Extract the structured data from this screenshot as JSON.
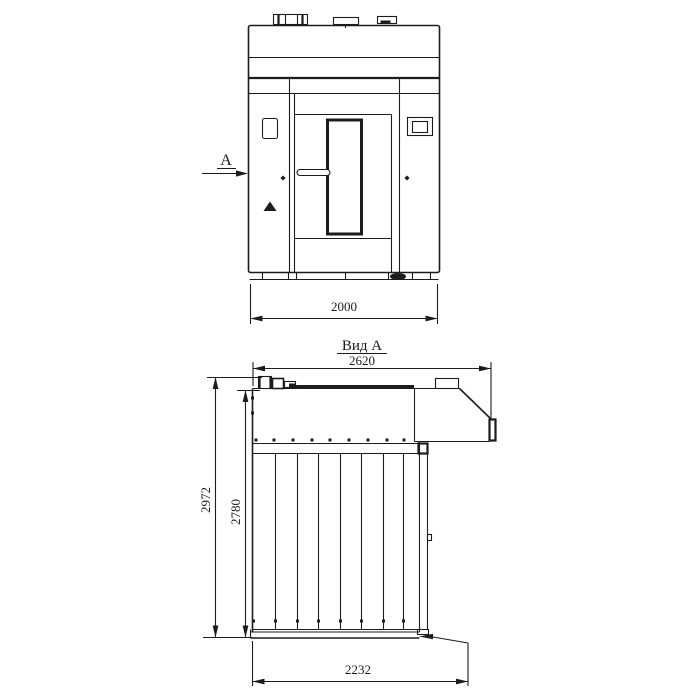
{
  "colors": {
    "line": "#1c1c1c",
    "background": "#ffffff"
  },
  "front_view": {
    "section_arrow_label": "A",
    "width_dimension": "2000"
  },
  "side_view": {
    "title": "Вид А",
    "depth_total_dimension": "2620",
    "height_total_dimension": "2972",
    "height_body_dimension": "2780",
    "depth_base_dimension": "2232"
  }
}
